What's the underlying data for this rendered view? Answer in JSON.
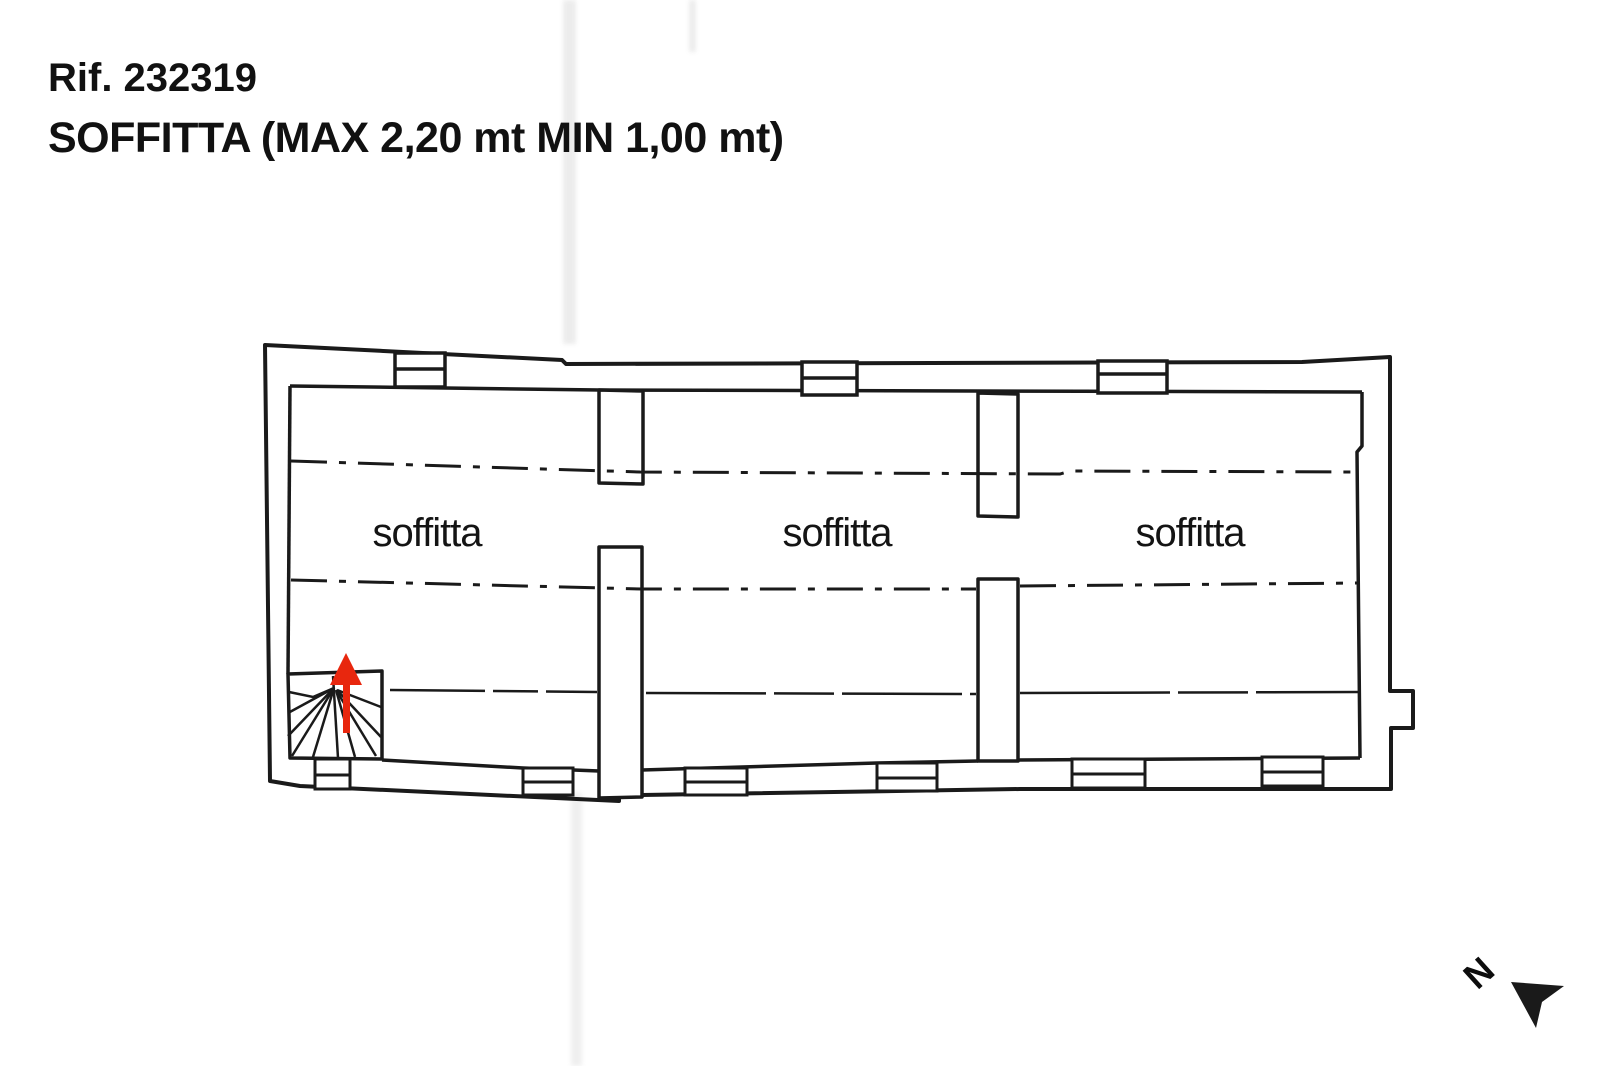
{
  "header": {
    "reference": "Rif. 232319",
    "title": "SOFFITTA (MAX 2,20 mt MIN 1,00 mt)"
  },
  "plan": {
    "rooms": [
      {
        "label": "soffitta"
      },
      {
        "label": "soffitta"
      },
      {
        "label": "soffitta"
      }
    ],
    "stairs": {
      "direction_arrow": "up"
    },
    "north_label": "N"
  },
  "colors": {
    "line": "#1a1a1a",
    "arrow_red": "#e8270e",
    "background": "#ffffff",
    "artifact": "#d6d6d6"
  }
}
